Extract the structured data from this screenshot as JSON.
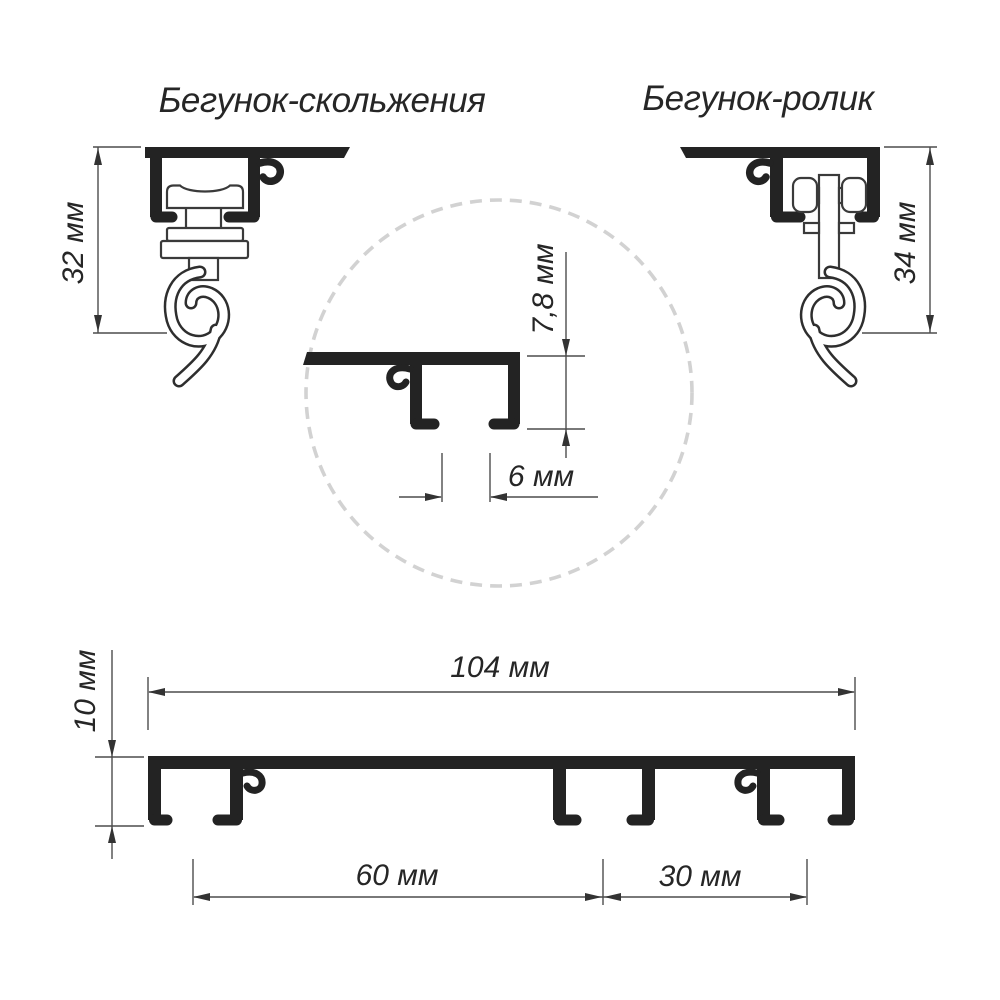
{
  "labels": {
    "slider_title": "Бегунок-скольжения",
    "roller_title": "Бегунок-ролик",
    "slider_height": "32 мм",
    "roller_height": "34 мм",
    "detail_profile_height": "7,8 мм",
    "detail_slot_width": "6 мм",
    "rail_total_width": "104 мм",
    "rail_profile_height": "10 мм",
    "channel_spacing_inner": "60 мм",
    "channel_spacing_outer": "30 мм"
  },
  "colors": {
    "ink": "#232323",
    "dimension_line": "#4d4d4d",
    "dashed_circle": "#d2d2d2",
    "text": "#262626",
    "background": "#ffffff"
  }
}
